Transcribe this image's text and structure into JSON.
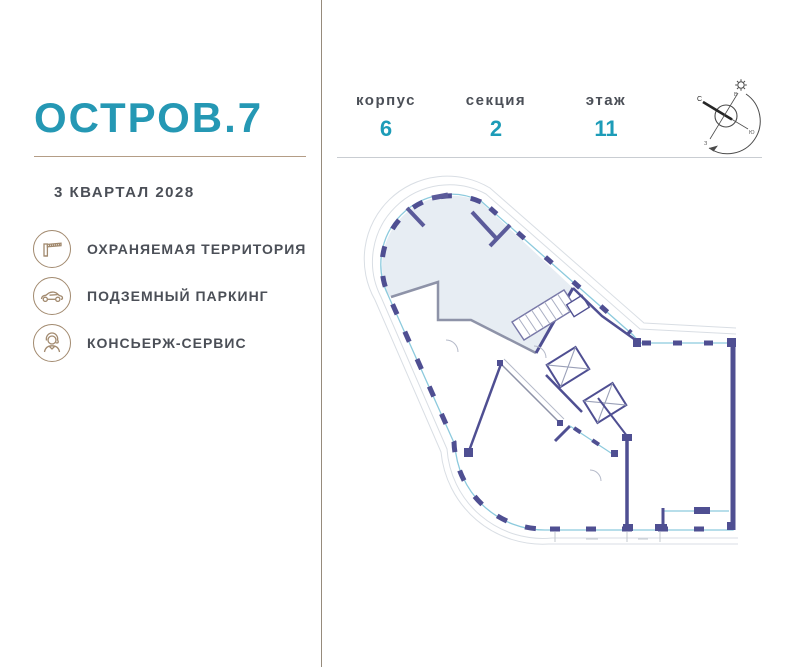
{
  "brand": {
    "title": "ОСТРОВ.7",
    "completion": "3 КВАРТАЛ 2028",
    "accent_color": "#2598b4",
    "underline_color": "#b49d86"
  },
  "features": [
    {
      "icon": "barrier-gate-icon",
      "label": "ОХРАНЯЕМАЯ ТЕРРИТОРИЯ"
    },
    {
      "icon": "car-icon",
      "label": "ПОДЗЕМНЫЙ ПАРКИНГ"
    },
    {
      "icon": "concierge-icon",
      "label": "КОНСЬЕРЖ-СЕРВИС"
    }
  ],
  "header": {
    "stats": [
      {
        "label": "корпус",
        "value": "6"
      },
      {
        "label": "секция",
        "value": "2"
      },
      {
        "label": "этаж",
        "value": "11"
      }
    ]
  },
  "compass": {
    "north": "С",
    "east": "В",
    "south": "Ю",
    "west": "З"
  },
  "floor_plan": {
    "highlight_fill": "#e7edf3",
    "wall_color": "#4f4f92",
    "window_glass_color": "#8ccadd",
    "outline_color": "#d9dee4",
    "boundary_gray": "#8e93a8"
  }
}
